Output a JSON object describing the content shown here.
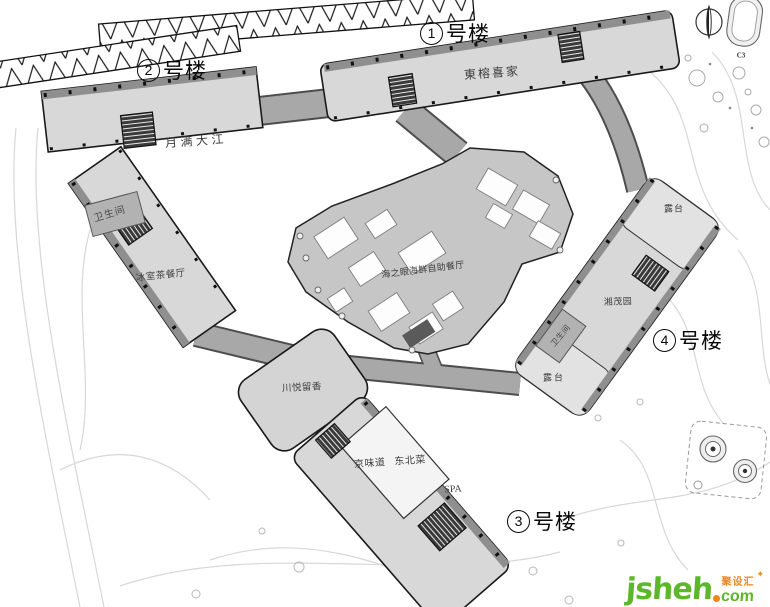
{
  "plan": {
    "tags": {
      "b1": "1",
      "b2": "2",
      "b3": "3",
      "b4": "4",
      "suffix": "号楼"
    },
    "tenants": {
      "dongrong": "東榕喜家",
      "yueman": "月满大江",
      "toilet_b2": "卫生间",
      "bingshi": "冰室茶餐厅",
      "haizhiyan": "海之眼海鲜自助餐厅",
      "terrace_top": "露台",
      "xiangmao": "湘茂园",
      "toilet_b4": "卫生间",
      "terrace_bottom": "露台",
      "chuanyue": "川悦留香",
      "jingweidao": "京味道",
      "dongbeicai": "东北菜",
      "spa": "SPA"
    },
    "compass_feature_label": "C3"
  },
  "watermark": {
    "name": "jsheh",
    "cn": "聚设汇",
    "tld": "com",
    "spark": "✦"
  },
  "colors": {
    "building": "#d8d8d8",
    "central": "#c6c6c6",
    "corridor": "#a8a8a8",
    "terrace": "#e2e2e2",
    "wm_green": "#5cb82a",
    "wm_orange": "#f08519"
  }
}
